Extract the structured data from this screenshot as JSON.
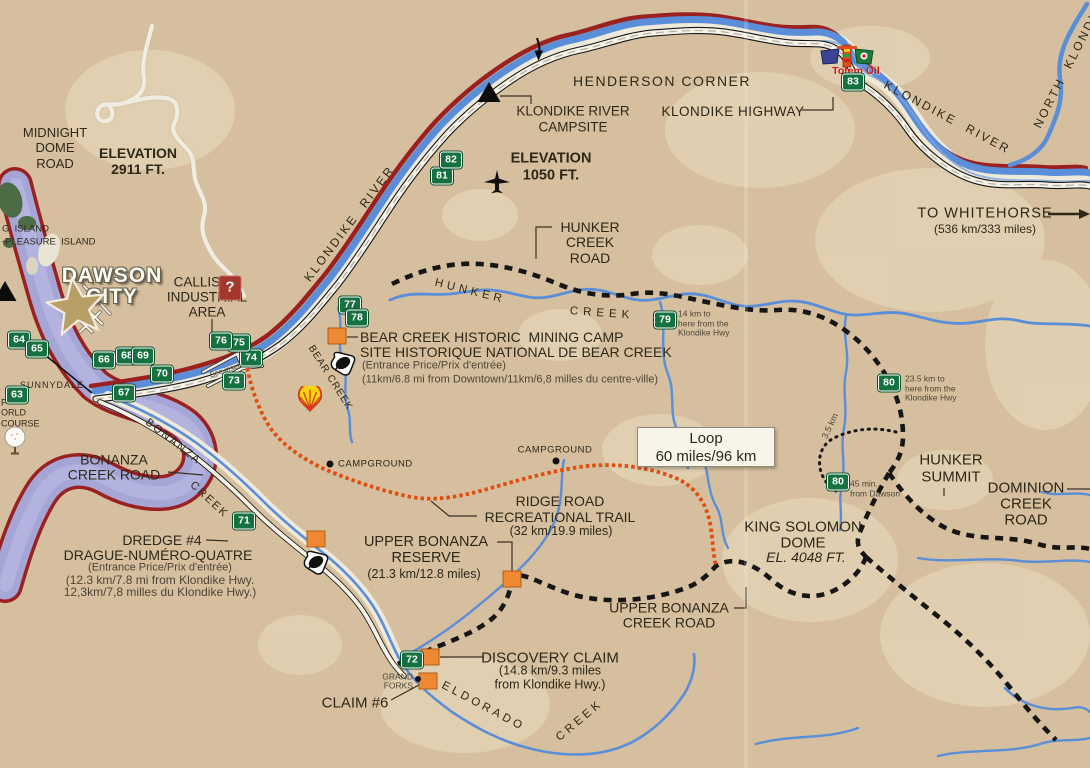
{
  "title": "Dawson City / Klondike area road map",
  "colors": {
    "background": "#d5bf9e",
    "light_patch": "#e6d7ba",
    "river_blue": "#5b8ed8",
    "yukon_lavender": "#a5a5d6",
    "shore_red": "#9b2020",
    "road_white": "#f6f2e8",
    "road_black": "#161616",
    "trail_orange": "#e04e10",
    "km_marker_green": "#15713f",
    "poi_orange": "#ee8833",
    "text": "#2e2818",
    "totem_red": "#cc1414"
  },
  "loop_box": {
    "line1": "Loop",
    "line2": "60 miles/96 km"
  },
  "labels": [
    {
      "id": "midnight-dome-road",
      "text": "MIDNIGHT\nDOME\nROAD",
      "x": 55,
      "y": 148,
      "size": 13,
      "lh": 1.18
    },
    {
      "id": "elevation-2911",
      "text": "ELEVATION\n2911 FT.",
      "x": 138,
      "y": 161,
      "size": 14,
      "bold": 1,
      "lh": 1.15
    },
    {
      "id": "big-island",
      "text": "G  ISLAND",
      "x": 2,
      "y": 230,
      "size": 9.5,
      "align": "left"
    },
    {
      "id": "pleasure-island",
      "text": "-PLEASURE  ISLAND",
      "x": 2,
      "y": 243,
      "size": 9.5,
      "align": "left"
    },
    {
      "id": "dawson-city",
      "text": "DAWSON\nCITY",
      "x": 112,
      "y": 286,
      "size": 21,
      "cls": "dawson",
      "lh": 1.0,
      "spacing": 1
    },
    {
      "id": "callison-industrial-area",
      "text": "CALLISON\nINDUSTRIAL\nAREA",
      "x": 207,
      "y": 298,
      "size": 13.5,
      "lh": 1.1
    },
    {
      "id": "henderson-corner",
      "text": "HENDERSON CORNER",
      "x": 662,
      "y": 81,
      "size": 14,
      "spacing": 1.5
    },
    {
      "id": "klondike-river-campsite",
      "text": "KLONDIKE RIVER\nCAMPSITE",
      "x": 573,
      "y": 119,
      "size": 13.5,
      "lh": 1.15
    },
    {
      "id": "klondike-highway",
      "text": "KLONDIKE HIGHWAY",
      "x": 733,
      "y": 112,
      "size": 13.5,
      "spacing": 0.5
    },
    {
      "id": "elevation-1050",
      "text": "ELEVATION\n1050 FT.",
      "x": 551,
      "y": 167,
      "size": 14.5,
      "bold": 1,
      "lh": 1.15
    },
    {
      "id": "to-whitehorse",
      "text": "TO WHITEHORSE",
      "x": 985,
      "y": 214,
      "size": 14.5,
      "spacing": 1
    },
    {
      "id": "whitehorse-distance",
      "text": "(536 km/333 miles)",
      "x": 985,
      "y": 230,
      "size": 12
    },
    {
      "id": "klondike-river-west",
      "text": "KLONDIKE  RIVER",
      "x": 350,
      "y": 224,
      "size": 12,
      "spacing": 2.5,
      "rotate": -53
    },
    {
      "id": "klondike-river-east",
      "text": "KLONDIKE  RIVER",
      "x": 947,
      "y": 118,
      "size": 12,
      "spacing": 2.5,
      "rotate": 28
    },
    {
      "id": "north-klondike-river",
      "text": "NORTH  KLONDIKE",
      "x": 1071,
      "y": 62,
      "size": 12,
      "spacing": 2.5,
      "rotate": -63
    },
    {
      "id": "hunker-creek-road",
      "text": "HUNKER\nCREEK\nROAD",
      "x": 590,
      "y": 243,
      "size": 14,
      "lh": 1.1
    },
    {
      "id": "hunker-creek-word1",
      "text": "HUNKER",
      "x": 470,
      "y": 292,
      "size": 11.5,
      "spacing": 4,
      "rotate": 14
    },
    {
      "id": "hunker-creek-word2",
      "text": "CREEK",
      "x": 602,
      "y": 314,
      "size": 11.5,
      "spacing": 5,
      "rotate": 4
    },
    {
      "id": "bear-creek-title",
      "text": "BEAR CREEK HISTORIC  MINING CAMP",
      "x": 360,
      "y": 337,
      "size": 14,
      "align": "left"
    },
    {
      "id": "bear-creek-title-fr",
      "text": "SITE HISTORIQUE NATIONAL DE BEAR CREEK",
      "x": 360,
      "y": 352,
      "size": 14,
      "align": "left"
    },
    {
      "id": "bear-creek-price",
      "text": "(Entrance Price/Prix d'entrée)",
      "x": 362,
      "y": 366,
      "size": 11,
      "align": "left",
      "cls": "note"
    },
    {
      "id": "bear-creek-distance",
      "text": "(11km/6.8 mi from Downtown/11km/6,8 milles du centre-ville)",
      "x": 362,
      "y": 380,
      "size": 11,
      "align": "left",
      "cls": "note"
    },
    {
      "id": "bear-creek-label",
      "text": "BEAR CREEK",
      "x": 330,
      "y": 378,
      "size": 10,
      "spacing": 1,
      "rotate": 58
    },
    {
      "id": "sunnydale",
      "text": "SUNNYDALE",
      "x": 52,
      "y": 385,
      "size": 9,
      "spacing": 1
    },
    {
      "id": "bonanza-creek-road",
      "text": "BONANZA\nCREEK ROAD",
      "x": 114,
      "y": 468,
      "size": 14,
      "lh": 1.1
    },
    {
      "id": "bonanza-creek-word1",
      "text": "BONANZA",
      "x": 173,
      "y": 442,
      "size": 11,
      "spacing": 2,
      "rotate": 38
    },
    {
      "id": "bonanza-creek-word2",
      "text": "CREEK",
      "x": 209,
      "y": 500,
      "size": 11,
      "spacing": 2,
      "rotate": 43
    },
    {
      "id": "dredge-4",
      "text": "DREDGE #4",
      "x": 162,
      "y": 540,
      "size": 14
    },
    {
      "id": "dredge-4-fr",
      "text": "DRAGUE-NUMÉRO-QUATRE",
      "x": 158,
      "y": 555,
      "size": 14
    },
    {
      "id": "dredge-4-price",
      "text": "(Entrance Price/Prix d'entrée)",
      "x": 160,
      "y": 568,
      "size": 11,
      "cls": "note"
    },
    {
      "id": "dredge-4-distance-1",
      "text": "(12.3 km/7.8 mi from Klondike Hwy.",
      "x": 160,
      "y": 581,
      "size": 12,
      "cls": "note"
    },
    {
      "id": "dredge-4-distance-2",
      "text": "12,3km/7,8 milles du Klondike Hwy.)",
      "x": 160,
      "y": 593,
      "size": 12,
      "cls": "note"
    },
    {
      "id": "campground-west",
      "text": "CAMPGROUND",
      "x": 338,
      "y": 465,
      "size": 9.5,
      "align": "left",
      "spacing": 0.5
    },
    {
      "id": "campground-mid",
      "text": "CAMPGROUND",
      "x": 555,
      "y": 451,
      "size": 9.5,
      "spacing": 0.5
    },
    {
      "id": "ridge-road-trail",
      "text": "RIDGE ROAD\nRECREATIONAL TRAIL",
      "x": 560,
      "y": 509,
      "size": 14,
      "lh": 1.15
    },
    {
      "id": "ridge-road-distance",
      "text": "(32 km/19.9 miles)",
      "x": 561,
      "y": 531,
      "size": 12.5
    },
    {
      "id": "upper-bonanza-reserve",
      "text": "UPPER BONANZA\nRESERVE",
      "x": 426,
      "y": 551,
      "size": 14.5,
      "lh": 1.1
    },
    {
      "id": "upper-bonanza-reserve-distance",
      "text": "(21.3 km/12.8 miles)",
      "x": 424,
      "y": 574,
      "size": 12.5
    },
    {
      "id": "king-solomon-dome",
      "text": "KING SOLOMON\nDOME",
      "x": 803,
      "y": 535,
      "size": 15,
      "lh": 1.05
    },
    {
      "id": "king-solomon-elevation",
      "text": "EL. 4048 FT.",
      "x": 806,
      "y": 557,
      "size": 14,
      "italic": 1
    },
    {
      "id": "upper-bonanza-creek-road",
      "text": "UPPER BONANZA\nCREEK ROAD",
      "x": 669,
      "y": 616,
      "size": 14,
      "lh": 1.1
    },
    {
      "id": "hunker-summit",
      "text": "HUNKER\nSUMMIT",
      "x": 951,
      "y": 469,
      "size": 15,
      "lh": 1.1
    },
    {
      "id": "dominion-creek-road",
      "text": "DOMINION\nCREEK\nROAD",
      "x": 1026,
      "y": 504,
      "size": 15,
      "lh": 1.05
    },
    {
      "id": "trail-3-5-km",
      "text": "3.5 km",
      "x": 830,
      "y": 426,
      "size": 9,
      "rotate": -65,
      "cls": "note"
    },
    {
      "id": "marker-79-note",
      "text": "14 km to\nhere from the\nKlondike Hwy",
      "x": 678,
      "y": 324,
      "size": 8.5,
      "align": "left",
      "lh": 1.12,
      "cls": "note"
    },
    {
      "id": "marker-80-note-a",
      "text": "23.5 km to\nhere from the\nKlondike Hwy",
      "x": 905,
      "y": 389,
      "size": 8.5,
      "align": "left",
      "lh": 1.12,
      "cls": "note"
    },
    {
      "id": "marker-80-note-b",
      "text": "45 min.\nfrom Dawson",
      "x": 850,
      "y": 489,
      "size": 8.5,
      "align": "left",
      "lh": 1.12,
      "cls": "note"
    },
    {
      "id": "discovery-claim",
      "text": "DISCOVERY CLAIM",
      "x": 550,
      "y": 658,
      "size": 15
    },
    {
      "id": "discovery-claim-distance",
      "text": "(14.8 km/9.3 miles\nfrom Klondike Hwy.)",
      "x": 550,
      "y": 678,
      "size": 12.5,
      "lh": 1.1
    },
    {
      "id": "claim-6",
      "text": "CLAIM #6",
      "x": 355,
      "y": 703,
      "size": 15
    },
    {
      "id": "grand-forks",
      "text": "GRAND\nFORKS",
      "x": 413,
      "y": 682,
      "size": 8.5,
      "align": "right",
      "lh": 1.1,
      "cls": "note"
    },
    {
      "id": "eldorado-creek-word1",
      "text": "ELDORADO",
      "x": 483,
      "y": 707,
      "size": 11.5,
      "spacing": 3.5,
      "rotate": 28
    },
    {
      "id": "eldorado-creek-word2",
      "text": "CREEK",
      "x": 580,
      "y": 721,
      "size": 11.5,
      "spacing": 3.5,
      "rotate": -40
    },
    {
      "id": "see-inset",
      "text": "See inset",
      "x": 225,
      "y": 371,
      "size": 7.5,
      "rotate": -18,
      "cls": "note"
    },
    {
      "id": "totem-oil",
      "text": "Totem Oil",
      "x": 856,
      "y": 71,
      "size": 10.5,
      "bold": 1,
      "color": "#cc1414",
      "cls": "totem-text"
    },
    {
      "id": "golf-course-partial",
      "text": "F\nORLD\nCOURSE",
      "x": 1,
      "y": 413,
      "size": 9,
      "align": "left",
      "lh": 1.15
    }
  ],
  "km_markers": [
    {
      "num": "63",
      "x": 17,
      "y": 395
    },
    {
      "num": "64",
      "x": 19,
      "y": 340
    },
    {
      "num": "65",
      "x": 37,
      "y": 349
    },
    {
      "num": "66",
      "x": 104,
      "y": 360
    },
    {
      "num": "67",
      "x": 124,
      "y": 393
    },
    {
      "num": "68",
      "x": 127,
      "y": 356
    },
    {
      "num": "69",
      "x": 143,
      "y": 356
    },
    {
      "num": "70",
      "x": 162,
      "y": 374
    },
    {
      "num": "71",
      "x": 244,
      "y": 521
    },
    {
      "num": "72",
      "x": 412,
      "y": 660
    },
    {
      "num": "73",
      "x": 234,
      "y": 381
    },
    {
      "num": "74",
      "x": 251,
      "y": 358
    },
    {
      "num": "75",
      "x": 239,
      "y": 343
    },
    {
      "num": "76",
      "x": 221,
      "y": 341
    },
    {
      "num": "77",
      "x": 350,
      "y": 305
    },
    {
      "num": "78",
      "x": 357,
      "y": 318
    },
    {
      "num": "79",
      "x": 665,
      "y": 320
    },
    {
      "num": "80",
      "x": 889,
      "y": 383
    },
    {
      "num": "80",
      "x": 838,
      "y": 482
    },
    {
      "num": "81",
      "x": 442,
      "y": 176
    },
    {
      "num": "82",
      "x": 451,
      "y": 160
    },
    {
      "num": "83",
      "x": 853,
      "y": 82
    }
  ],
  "poi_squares": [
    {
      "id": "bear-creek-site",
      "x": 337,
      "y": 336
    },
    {
      "id": "dredge-4-site",
      "x": 316,
      "y": 539
    },
    {
      "id": "upper-bonanza-reserve-site",
      "x": 512,
      "y": 579
    },
    {
      "id": "discovery-claim-site",
      "x": 430,
      "y": 657
    },
    {
      "id": "claim-6-site",
      "x": 428,
      "y": 681
    }
  ],
  "icons": [
    {
      "type": "campsite",
      "x": 489,
      "y": 92
    },
    {
      "type": "campsite",
      "x": 5,
      "y": 291
    },
    {
      "type": "airplane",
      "x": 497,
      "y": 183
    },
    {
      "type": "golf",
      "x": 15,
      "y": 441
    },
    {
      "type": "shell",
      "x": 310,
      "y": 399
    },
    {
      "type": "info",
      "x": 230,
      "y": 288
    },
    {
      "type": "goldpan",
      "x": 343,
      "y": 363
    },
    {
      "type": "goldpan",
      "x": 316,
      "y": 562
    },
    {
      "type": "star",
      "x": 76,
      "y": 306
    },
    {
      "type": "campground-dot",
      "x": 330,
      "y": 464
    },
    {
      "type": "campground-dot",
      "x": 556,
      "y": 461
    },
    {
      "type": "settlement-dot",
      "x": 418,
      "y": 679
    },
    {
      "type": "flow-arrow",
      "x": 538,
      "y": 50
    },
    {
      "type": "totem",
      "x": 847,
      "y": 56
    }
  ]
}
